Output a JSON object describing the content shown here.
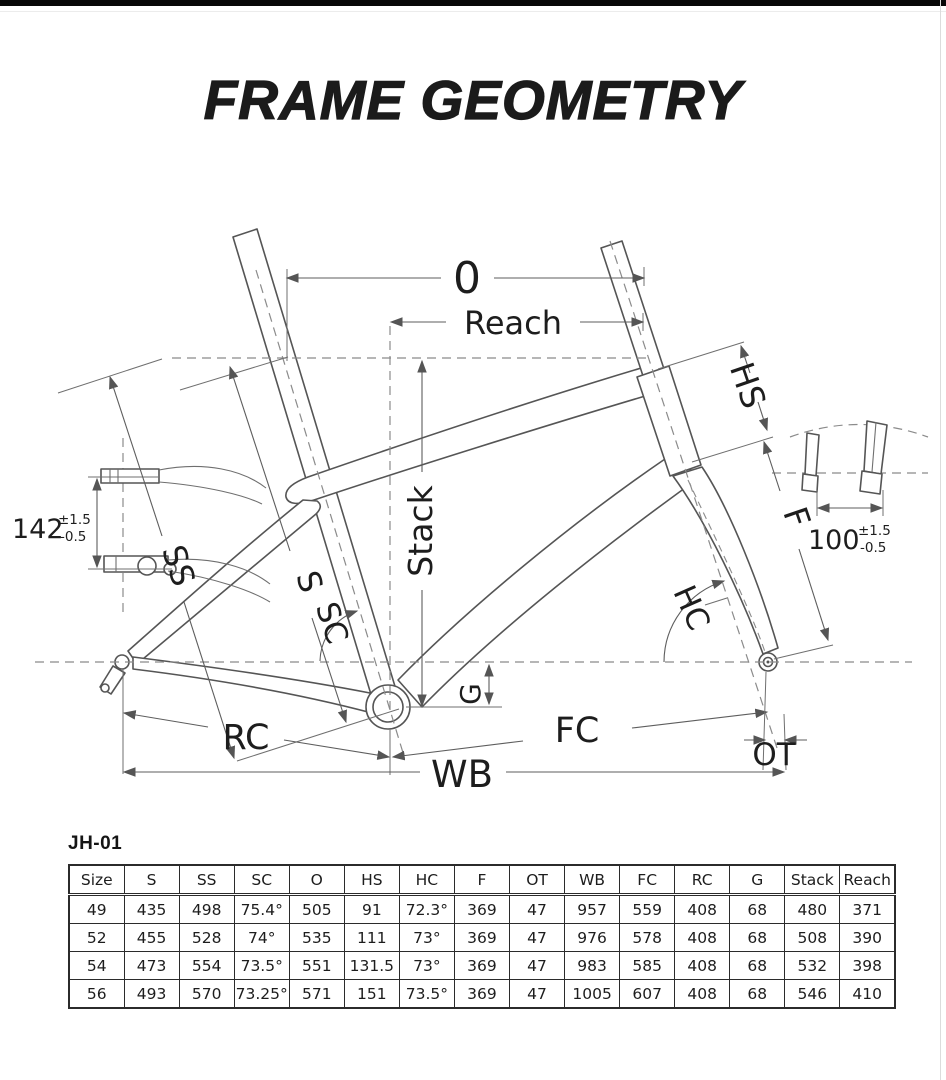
{
  "page": {
    "title": "FRAME GEOMETRY",
    "model": "JH-01"
  },
  "diagram": {
    "labels": {
      "o": "0",
      "reach": "Reach",
      "stack": "Stack",
      "hs": "HS",
      "f": "F",
      "ss": "SS",
      "s": "S",
      "sc": "SC",
      "hc": "HC",
      "g": "G",
      "rc": "RC",
      "fc": "FC",
      "wb": "WB",
      "ot": "OT"
    },
    "rear_spacing": {
      "value": "142",
      "tol_top": "±1.5",
      "tol_bottom": "-0.5"
    },
    "front_spacing": {
      "value": "100",
      "tol_top": "±1.5",
      "tol_bottom": "-0.5"
    }
  },
  "table": {
    "columns": [
      "Size",
      "S",
      "SS",
      "SC",
      "O",
      "HS",
      "HC",
      "F",
      "OT",
      "WB",
      "FC",
      "RC",
      "G",
      "Stack",
      "Reach"
    ],
    "rows": [
      [
        "49",
        "435",
        "498",
        "75.4°",
        "505",
        "91",
        "72.3°",
        "369",
        "47",
        "957",
        "559",
        "408",
        "68",
        "480",
        "371"
      ],
      [
        "52",
        "455",
        "528",
        "74°",
        "535",
        "111",
        "73°",
        "369",
        "47",
        "976",
        "578",
        "408",
        "68",
        "508",
        "390"
      ],
      [
        "54",
        "473",
        "554",
        "73.5°",
        "551",
        "131.5",
        "73°",
        "369",
        "47",
        "983",
        "585",
        "408",
        "68",
        "532",
        "398"
      ],
      [
        "56",
        "493",
        "570",
        "73.25°",
        "571",
        "151",
        "73.5°",
        "369",
        "47",
        "1005",
        "607",
        "408",
        "68",
        "546",
        "410"
      ]
    ]
  }
}
